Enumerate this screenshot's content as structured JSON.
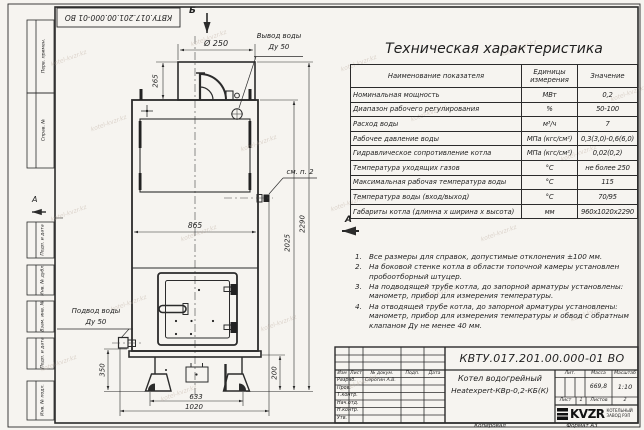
{
  "sheet": {
    "stamp_top": "КВТУ.017.201.00.000-01 ВО",
    "margin_labels": [
      "Перв. примен.",
      "Справ. №",
      "Подп. и дата",
      "Инв. № дубл.",
      "Взам. инв. №",
      "Подп. и дата",
      "Инв. № подл."
    ],
    "zone_marker_left": "А",
    "footer": {
      "copied": "Копировал",
      "format": "Формат А3"
    }
  },
  "view_markers": {
    "top": "Б",
    "side": "А"
  },
  "drawing_labels": {
    "flue_diameter": "Ø 250",
    "outlet_label_1": "Вывод воды",
    "outlet_label_2": "Ду 50",
    "inlet_label_1": "Подвод воды",
    "inlet_label_2": "Ду 50",
    "see_note": "см. п. 2",
    "dim_265": "265",
    "dim_865": "865",
    "dim_2290": "2290",
    "dim_2025": "2025",
    "dim_350": "350",
    "dim_200": "200",
    "dim_633": "633",
    "dim_1020": "1020"
  },
  "spec_table": {
    "title": "Техническая характеристика",
    "headers": [
      "Наименование показателя",
      "Единицы измерения",
      "Значение"
    ],
    "rows": [
      [
        "Номинальная мощность",
        "МВт",
        "0,2"
      ],
      [
        "Диапазон рабочего регулирования",
        "%",
        "50-100"
      ],
      [
        "Расход воды",
        "м³/ч",
        "7"
      ],
      [
        "Рабочее давление воды",
        "МПа (кгс/см²)",
        "0,3(3,0)-0,6(6,0)"
      ],
      [
        "Гидравлическое сопротивление котла",
        "МПа (кгс/см²)",
        "0,02(0,2)"
      ],
      [
        "Температура уходящих газов",
        "°С",
        "не более 250"
      ],
      [
        "Максимальная рабочая температура воды",
        "°С",
        "115"
      ],
      [
        "Температура воды (вход/выход)",
        "°С",
        "70/95"
      ],
      [
        "Габариты котла (длинна х ширина х высота)",
        "мм",
        "960х1020х2290"
      ]
    ]
  },
  "notes": [
    {
      "num": "1.",
      "text": "Все размеры для справок, допустимые отклонения ±100 мм."
    },
    {
      "num": "2.",
      "text": "На боковой стенке котла в области топочной камеры установлен пробоотборный штуцер."
    },
    {
      "num": "3.",
      "text": "На подводящей трубе котла, до запорной арматуры установлены: манометр, прибор для измерения температуры."
    },
    {
      "num": "4.",
      "text": "На отводящей трубе котла, до запорной арматуры установлены: манометр, прибор для измерения температуры и обвод с обратным клапаном Ду не менее 40 мм."
    }
  ],
  "title_block": {
    "doc_number": "КВТУ.017.201.00.000-01 ВО",
    "product_line_1": "Котел водогрейный",
    "product_line_2": "Heatexpert-КВр-0,2-КБ(К)",
    "rev_cols": [
      "Изм",
      "Лист",
      "№ докум.",
      "Подп.",
      "Дата"
    ],
    "role_rows": [
      "Разраб.",
      "Пров.",
      "Т.контр.",
      "Нач.отд.",
      "Н.контр.",
      "Утв."
    ],
    "developer_name": "Серогин А.В.",
    "lit_label": "Лит.",
    "mass_label": "Масса",
    "mass_value": "669,8",
    "scale_label": "Масштаб",
    "scale_value": "1:10",
    "sheet_label": "Лист",
    "sheet_value": "1",
    "sheets_label": "Листов",
    "sheets_value": "2",
    "logo_text": "KVZR",
    "logo_sub_1": "КОТЕЛЬНЫЙ",
    "logo_sub_2": "ЗАВОД РЭП"
  },
  "watermark": {
    "text": "kotel-kvzr.kz"
  },
  "colors": {
    "line": "#2b2b2b",
    "paper": "#f6f4f0",
    "watermark": "#b9a89a"
  }
}
